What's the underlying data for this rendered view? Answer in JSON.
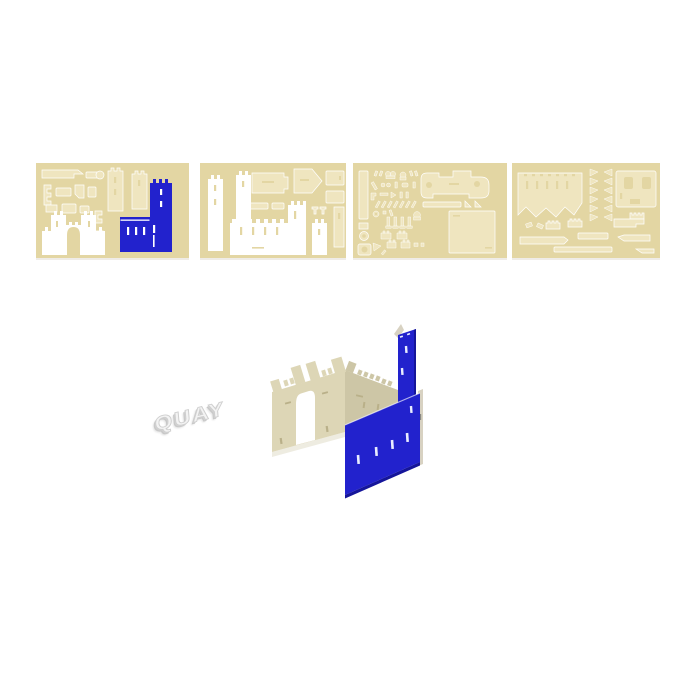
{
  "scene": {
    "description": "Product photo of a 3D castle model kit: four die-cut board sheets above a partially assembled castle and 3D letters",
    "background": "#ffffff",
    "quay_text": "QUAY",
    "colors": {
      "page_bg": "#ffffff",
      "sheet_base": "#e3d6a3",
      "piece_light": "#efe5bf",
      "piece_white": "#ffffff",
      "blue": "#2222cd",
      "blue_dark": "#15159a",
      "model_tan": "#ddd6b6",
      "model_tan_shade": "#cdc6a6",
      "edge_tan": "#d8d2c2",
      "quay_fill": "#f3f3f3",
      "quay_stroke": "#cfcfcf"
    },
    "sheets": [
      {
        "id": "sheet-1",
        "contents": "tan punch-out parts, white castle gatehouse piece, blue wall-with-tower piece"
      },
      {
        "id": "sheet-2",
        "contents": "white towers and large white castle wall, tan roof and panel pieces"
      },
      {
        "id": "sheet-3",
        "contents": "many small tan punch-out parts and one large square panel"
      },
      {
        "id": "sheet-4",
        "contents": "large tan wall piece, triangle strips, panel with cutouts, tan strips"
      }
    ],
    "model_parts": [
      "tan-gate-wall-with-arch",
      "tan-crenellated-back-wall",
      "blue-side-wall-with-slots",
      "blue-square-tower"
    ]
  }
}
